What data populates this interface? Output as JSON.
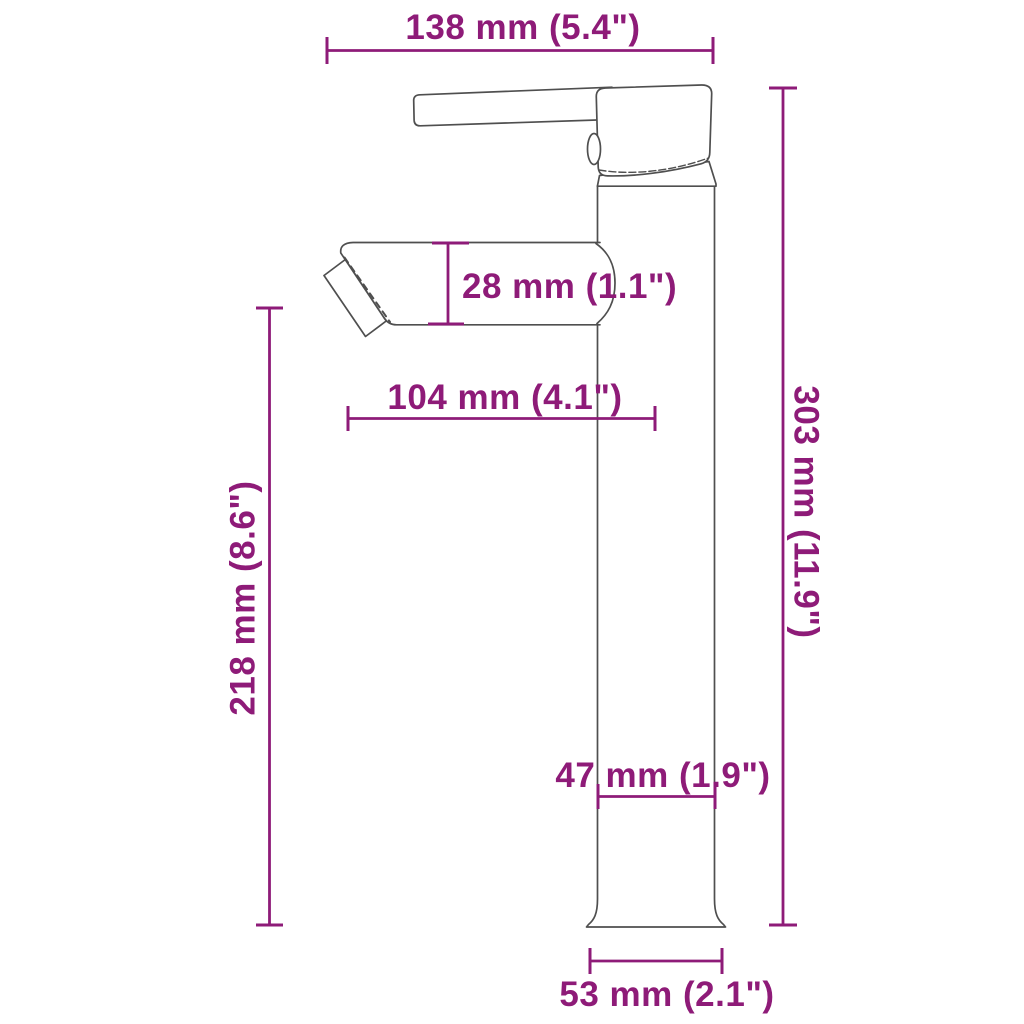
{
  "title": "Bathroom basin mixer tap — side view dimension drawing",
  "theme": {
    "dimension_color": "#8E1B78",
    "outline_color": "#4F4F4F",
    "background": "#FFFFFF"
  },
  "drawing": {
    "object": "single-lever vessel sink faucet, side view line drawing",
    "parts": [
      "handle-lever",
      "cartridge-cap",
      "collar",
      "body-column",
      "spout",
      "aerator",
      "flared-base"
    ]
  },
  "dimensions": {
    "top_width": {
      "label": "138 mm (5.4\")",
      "value_mm": 138,
      "value_in": 5.4,
      "orientation": "horizontal"
    },
    "spout_height": {
      "label": "28 mm (1.1\")",
      "value_mm": 28,
      "value_in": 1.1,
      "orientation": "vertical"
    },
    "spout_reach": {
      "label": "104 mm (4.1\")",
      "value_mm": 104,
      "value_in": 4.1,
      "orientation": "horizontal"
    },
    "spout_to_base": {
      "label": "218 mm (8.6\")",
      "value_mm": 218,
      "value_in": 8.6,
      "orientation": "vertical-rotated"
    },
    "total_height": {
      "label": "303 mm (11.9\")",
      "value_mm": 303,
      "value_in": 11.9,
      "orientation": "vertical-rotated"
    },
    "body_width": {
      "label": "47 mm (1.9\")",
      "value_mm": 47,
      "value_in": 1.9,
      "orientation": "horizontal"
    },
    "base_width": {
      "label": "53 mm (2.1\")",
      "value_mm": 53,
      "value_in": 2.1,
      "orientation": "horizontal"
    }
  }
}
